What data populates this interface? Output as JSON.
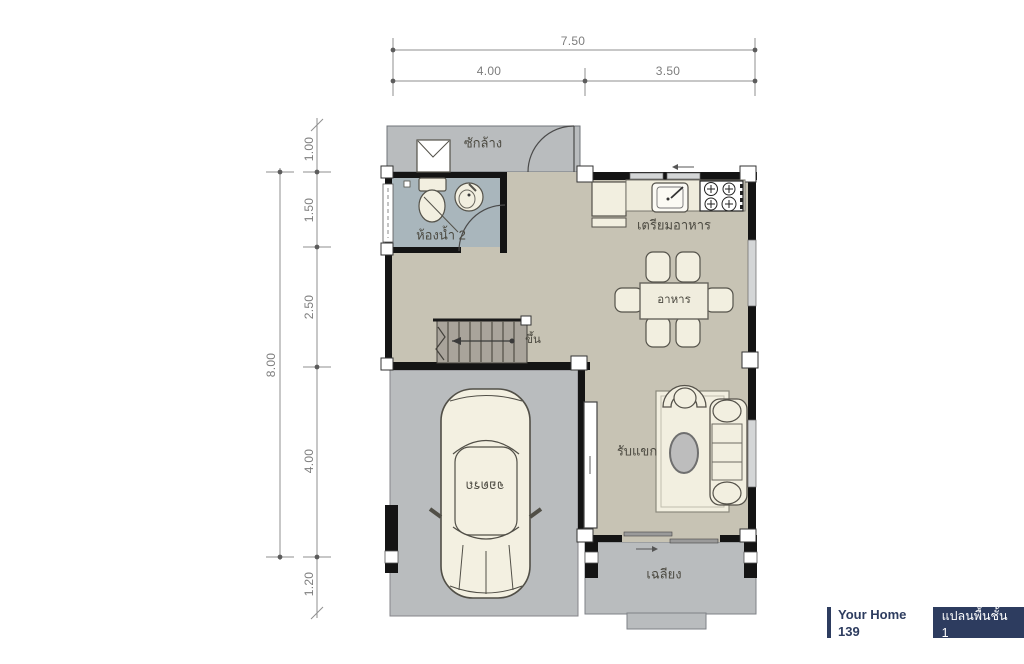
{
  "plan": {
    "rooms": {
      "laundry": {
        "label": "ซักล้าง"
      },
      "bathroom2": {
        "label": "ห้องน้ำ 2"
      },
      "kitchen": {
        "label": "เตรียมอาหาร"
      },
      "dining": {
        "label": "อาหาร"
      },
      "living": {
        "label": "รับแขก"
      },
      "carport": {
        "label": "จอดรถ"
      },
      "porch": {
        "label": "เฉลียง"
      }
    },
    "stairs": {
      "label": "ขึ้น"
    },
    "dimensions": {
      "top_total": "7.50",
      "top_segments": [
        "4.00",
        "3.50"
      ],
      "left_total": "8.00",
      "left_segments": [
        "1.00",
        "1.50",
        "2.50",
        "4.00",
        "1.20"
      ]
    }
  },
  "badge": {
    "brand": "Your Home 139",
    "caption": "แปลนพื้นชั้น 1"
  },
  "colors": {
    "floor_beige": "#c7c3b4",
    "outdoor_gray": "#b9bcbe",
    "bathroom_blue": "#a9b6bc",
    "wall_black": "#141414",
    "furniture_cream": "#f2efe0",
    "badge_navy": "#2d3c5f"
  }
}
